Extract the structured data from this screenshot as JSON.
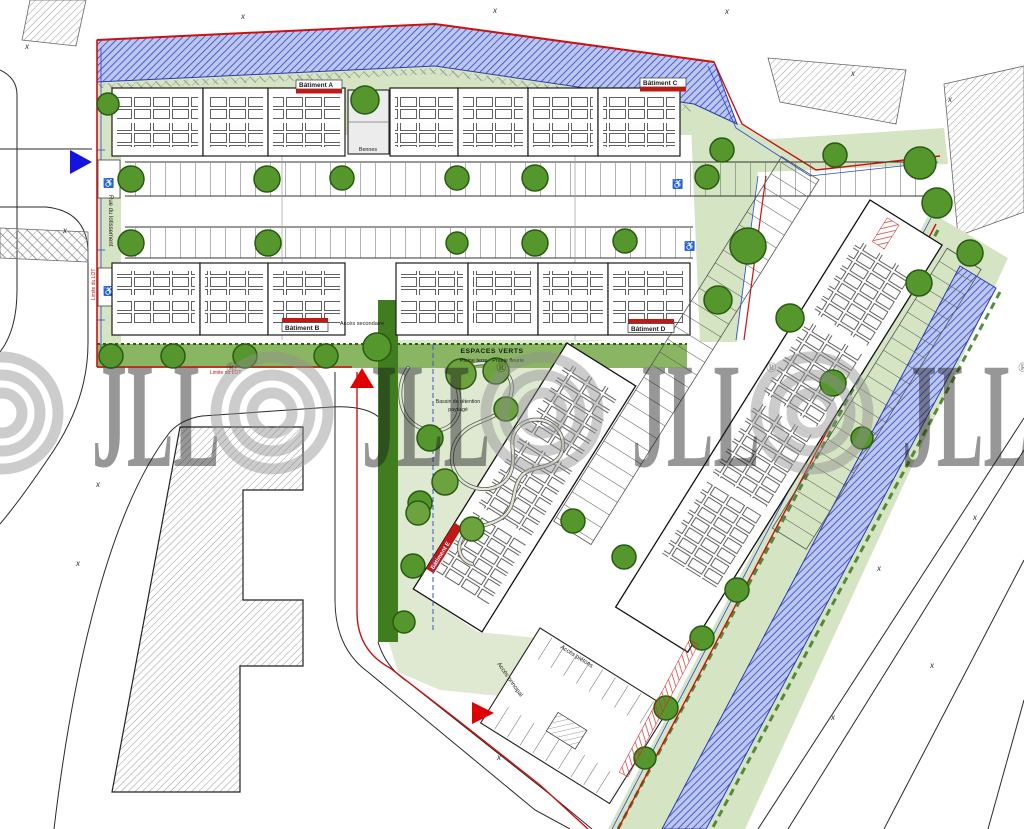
{
  "labels": {
    "building_a": "Bâtiment A",
    "building_b": "Bâtiment B",
    "building_c": "Bâtiment C",
    "building_d": "Bâtiment D",
    "building_e": "Bâtiment E",
    "bennes": "Bennes",
    "acces_secondaire": "Accès secondaire",
    "acces_principal": "Accès principal",
    "acces_pietons": "Accès piétons",
    "espaces_verts_title": "ESPACES VERTS",
    "espaces_verts_subtitle": "Pleine terre - Prairie fleurie",
    "bassin_line1": "Bassin de rétention",
    "bassin_line2": "paysagé",
    "limite_lot": "Limite du LOT",
    "rue_left": "Rue du lotissement"
  },
  "watermark": {
    "brand": "JLL",
    "registered": "®"
  },
  "icons": {
    "wheelchair": "♿",
    "survey_mark": "x"
  },
  "colors": {
    "boundary_red": "#cc1111",
    "boundary_blue": "#2847d8",
    "canal_blue_line": "#3042c0",
    "canal_blue_bg": "#bcc7f0",
    "green_pale": "#d5e4c2",
    "green_lawn": "#8ab663",
    "green_hedge": "#3f7d1e",
    "tree_green": "#55972c",
    "watermark_gray": "#8f8f8f"
  }
}
